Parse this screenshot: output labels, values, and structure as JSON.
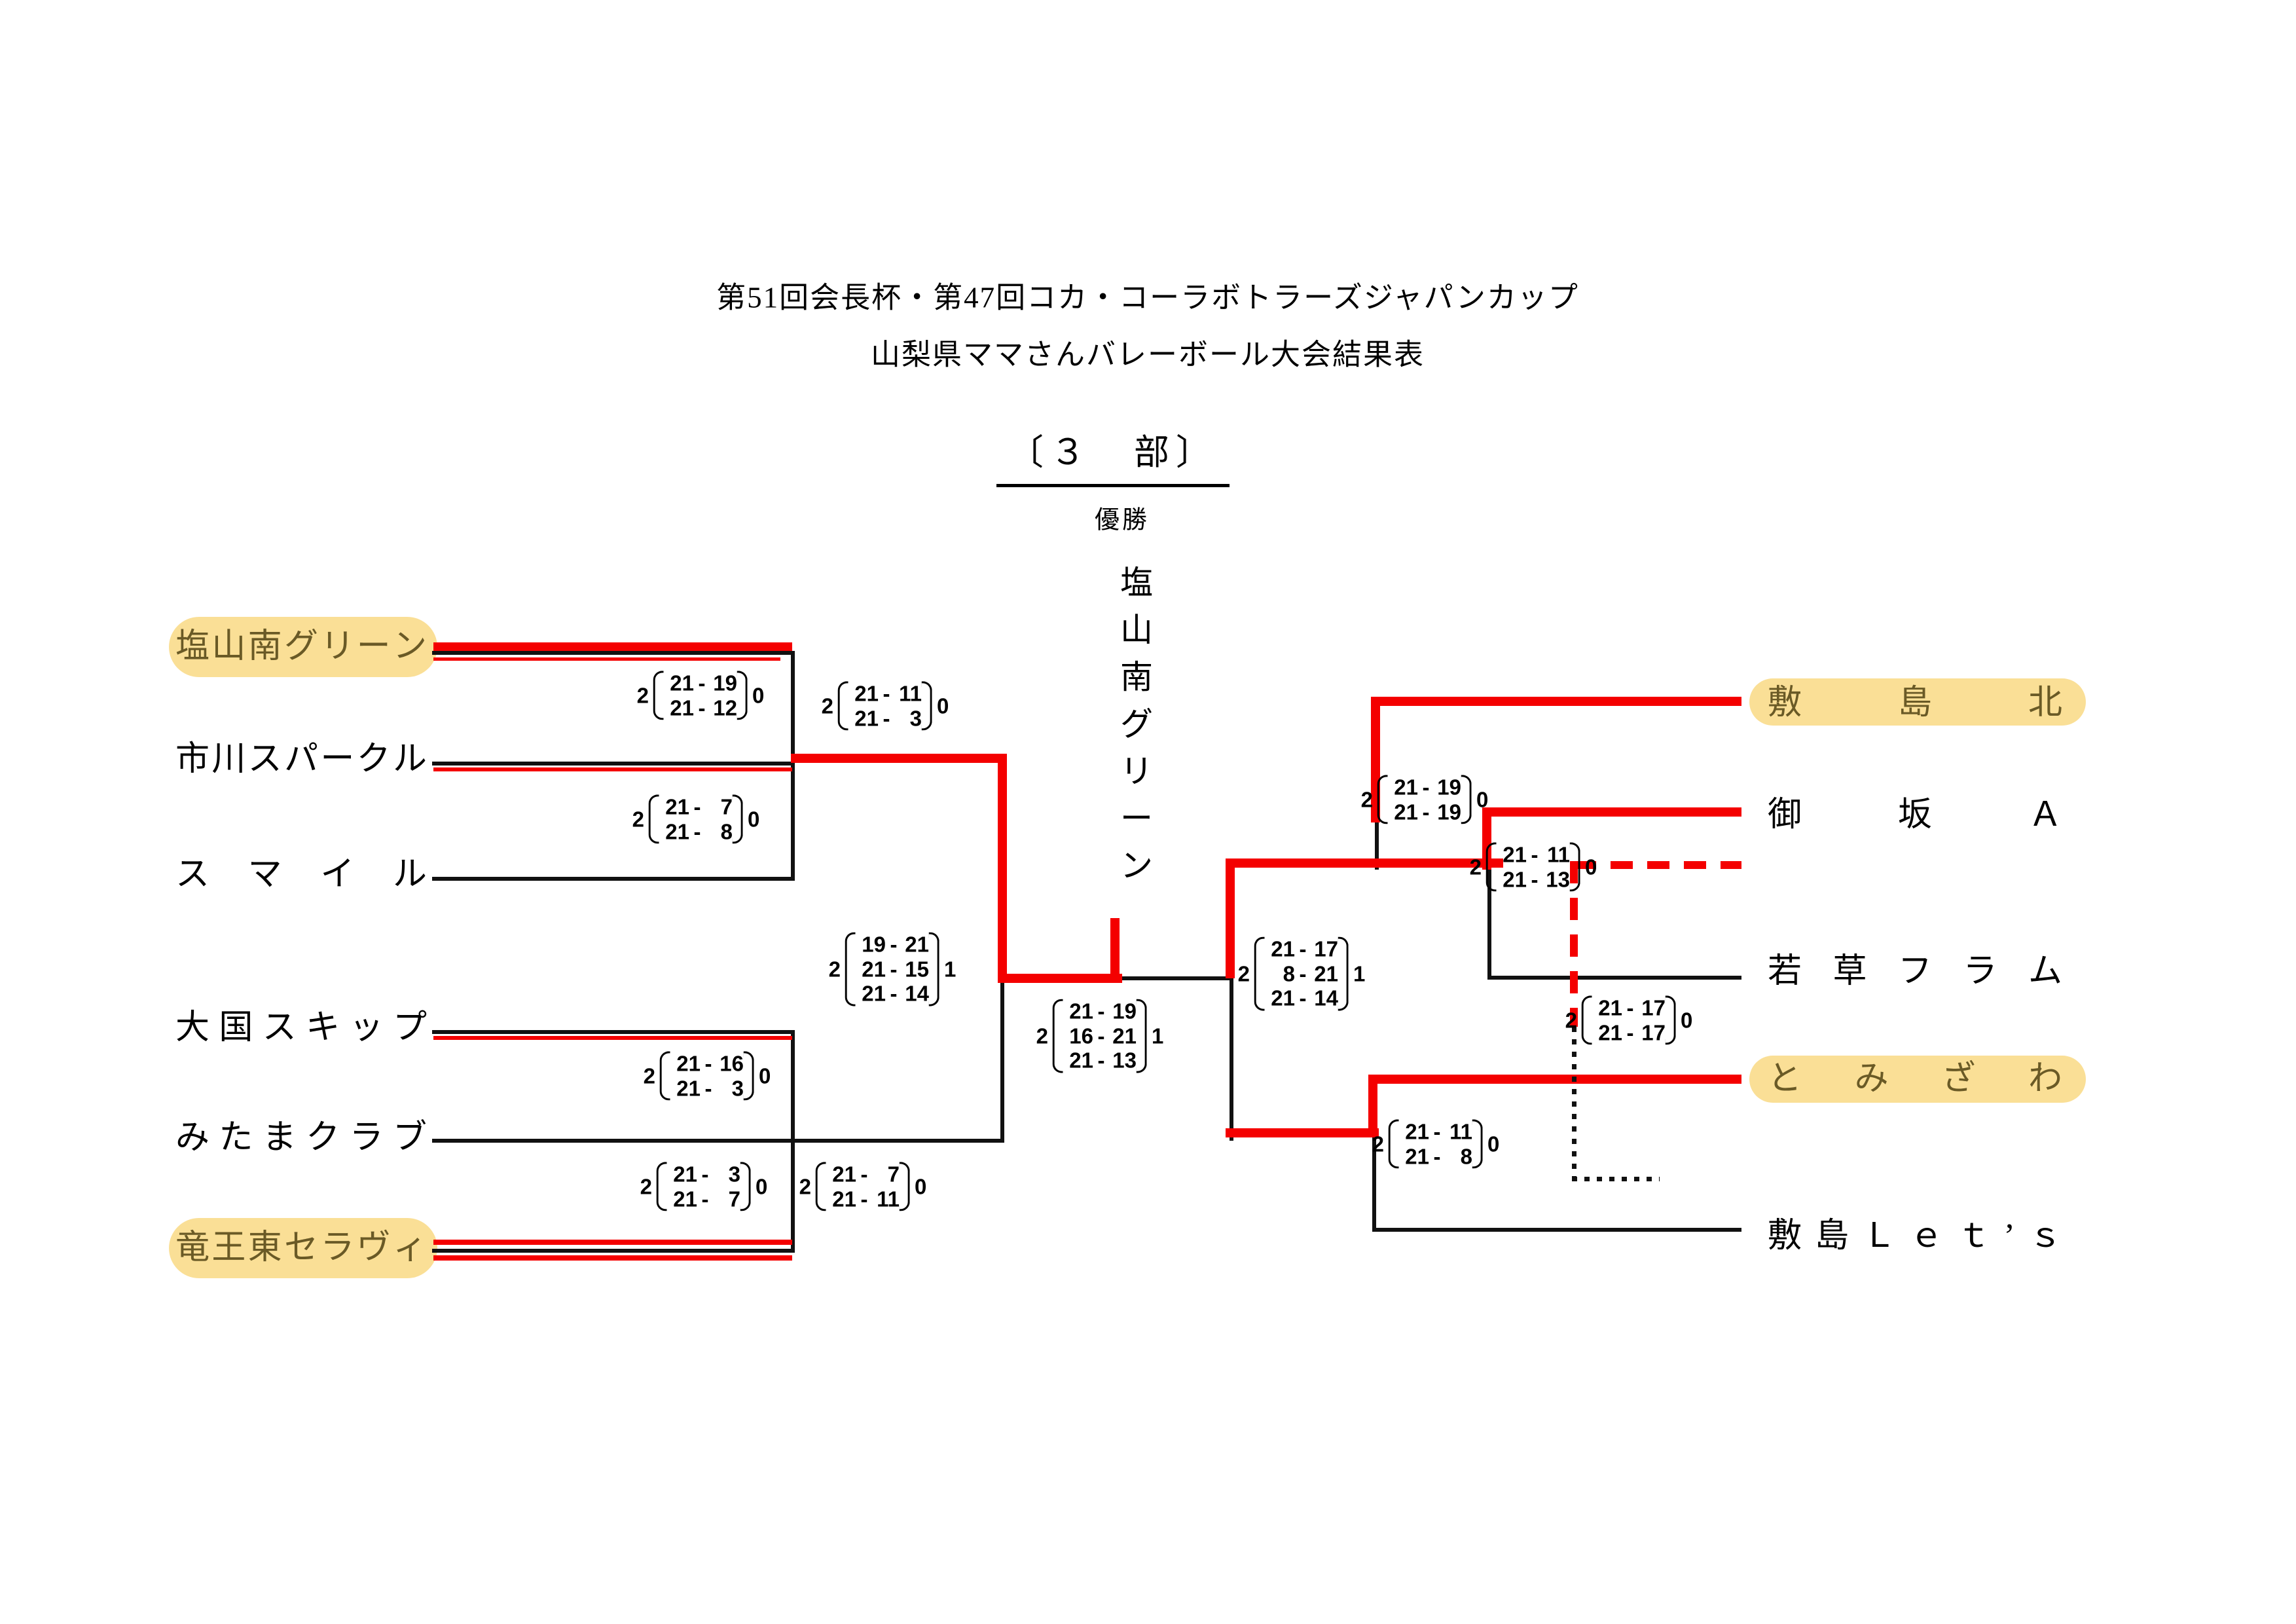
{
  "header": {
    "title_line1": "第51回会長杯・第47回コカ・コーラボトラーズジャパンカップ",
    "title_line2": "山梨県ママさんバレーボール大会結果表",
    "section_heading": "〔３　部〕",
    "champion_label": "優勝",
    "champion_name": "塩山南グリーン"
  },
  "colors": {
    "winner_path_red": "#f40000",
    "bracket_black": "#111111",
    "highlight_yellow": "#fadf96",
    "highlight_text": "#6a5a26"
  },
  "teams": {
    "left": [
      {
        "name": "塩山南グリーン",
        "highlighted": true
      },
      {
        "name": "市川スパークル",
        "highlighted": false
      },
      {
        "name": "スマイル",
        "highlighted": false
      },
      {
        "name": "大国スキップ",
        "highlighted": false
      },
      {
        "name": "みたまクラブ",
        "highlighted": false
      },
      {
        "name": "竜王東セラヴィ",
        "highlighted": true
      }
    ],
    "right": [
      {
        "name": "敷島北",
        "highlighted": true
      },
      {
        "name": "御坂Ａ",
        "highlighted": false
      },
      {
        "name": "若草フラム",
        "highlighted": false
      },
      {
        "name": "とみざわ",
        "highlighted": true
      },
      {
        "name": "敷島Ｌｅｔ’ｓ",
        "highlighted": false
      }
    ]
  },
  "matches": [
    {
      "top": "2",
      "bottom": "0",
      "sets": [
        [
          "21",
          "19"
        ],
        [
          "21",
          "12"
        ]
      ]
    },
    {
      "top": "2",
      "bottom": "0",
      "sets": [
        [
          "21",
          "7"
        ],
        [
          "21",
          "8"
        ]
      ]
    },
    {
      "top": "2",
      "bottom": "0",
      "sets": [
        [
          "21",
          "11"
        ],
        [
          "21",
          "3"
        ]
      ]
    },
    {
      "top": "2",
      "bottom": "0",
      "sets": [
        [
          "21",
          "16"
        ],
        [
          "21",
          "3"
        ]
      ]
    },
    {
      "top": "2",
      "bottom": "0",
      "sets": [
        [
          "21",
          "3"
        ],
        [
          "21",
          "7"
        ]
      ]
    },
    {
      "top": "2",
      "bottom": "0",
      "sets": [
        [
          "21",
          "7"
        ],
        [
          "21",
          "11"
        ]
      ]
    },
    {
      "top": "2",
      "bottom": "1",
      "sets": [
        [
          "19",
          "21"
        ],
        [
          "21",
          "15"
        ],
        [
          "21",
          "14"
        ]
      ]
    },
    {
      "top": "2",
      "bottom": "1",
      "sets": [
        [
          "21",
          "19"
        ],
        [
          "16",
          "21"
        ],
        [
          "21",
          "13"
        ]
      ]
    },
    {
      "top": "2",
      "bottom": "1",
      "sets": [
        [
          "21",
          "17"
        ],
        [
          "8",
          "21"
        ],
        [
          "21",
          "14"
        ]
      ]
    },
    {
      "top": "2",
      "bottom": "0",
      "sets": [
        [
          "21",
          "19"
        ],
        [
          "21",
          "19"
        ]
      ]
    },
    {
      "top": "2",
      "bottom": "0",
      "sets": [
        [
          "21",
          "11"
        ],
        [
          "21",
          "13"
        ]
      ]
    },
    {
      "top": "2",
      "bottom": "0",
      "sets": [
        [
          "21",
          "17"
        ],
        [
          "21",
          "17"
        ]
      ]
    },
    {
      "top": "2",
      "bottom": "0",
      "sets": [
        [
          "21",
          "11"
        ],
        [
          "21",
          "8"
        ]
      ]
    }
  ]
}
